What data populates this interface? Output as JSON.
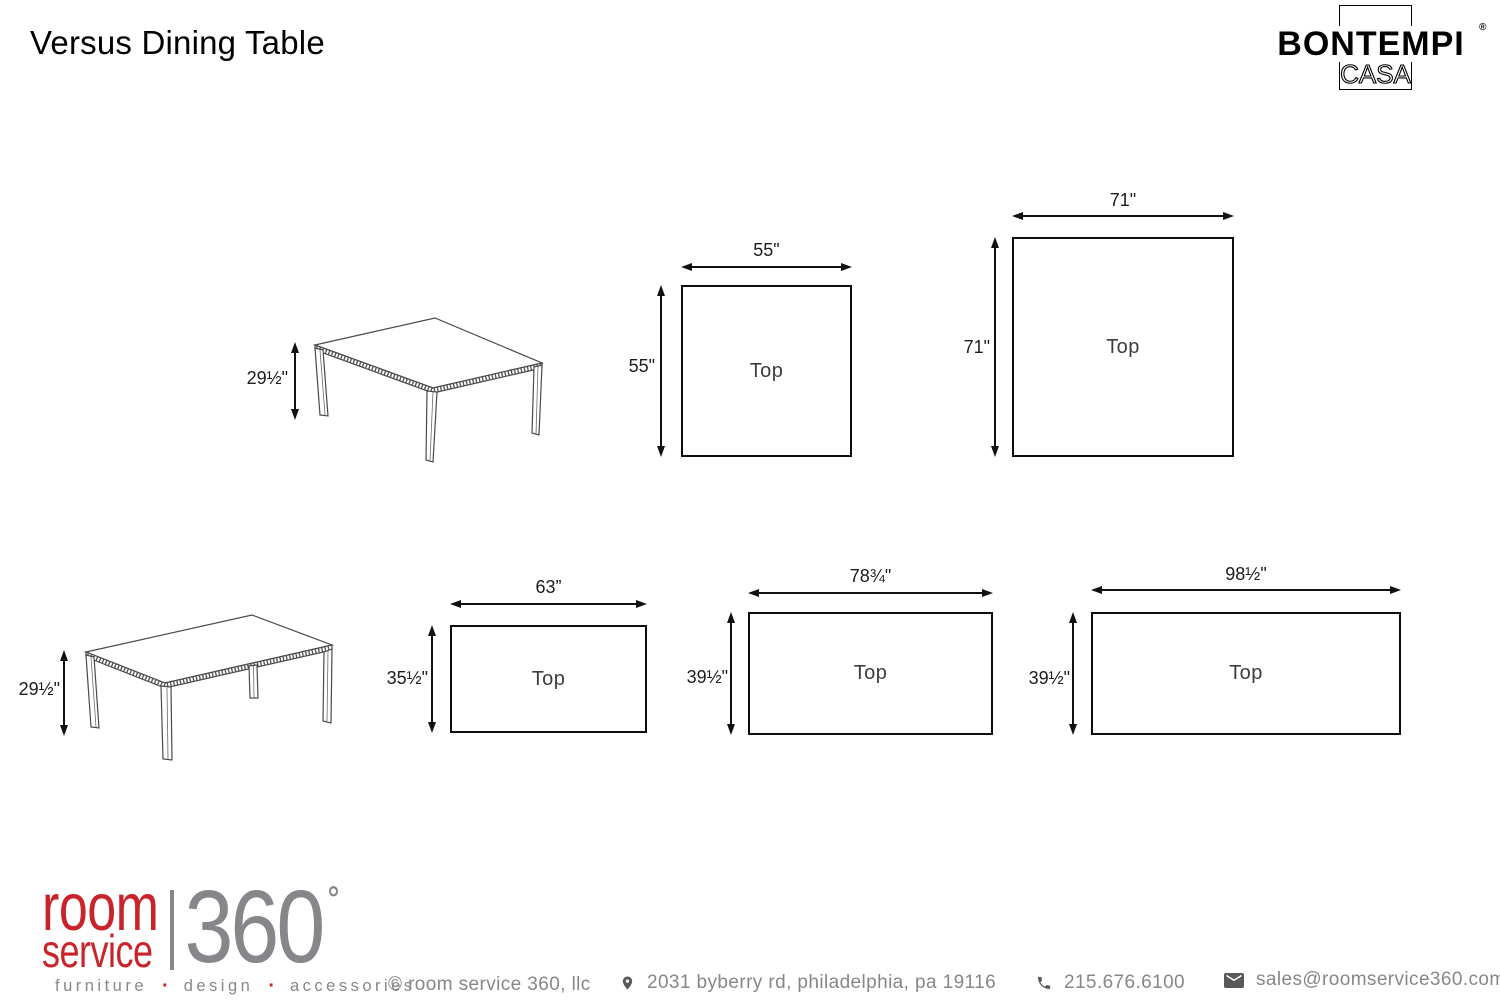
{
  "page": {
    "title": "Versus Dining Table"
  },
  "brand": {
    "name": "BONTEMPI",
    "registered_mark": "®",
    "subtitle": "CASA"
  },
  "side_views": [
    {
      "shape": "square-table",
      "height_label": "29½\""
    },
    {
      "shape": "rectangular-table",
      "height_label": "29½\""
    }
  ],
  "top_views": [
    {
      "width_label": "55\"",
      "height_label": "55\"",
      "area_label": "Top"
    },
    {
      "width_label": "71\"",
      "height_label": "71\"",
      "area_label": "Top"
    },
    {
      "width_label": "63”",
      "height_label": "35½\"",
      "area_label": "Top"
    },
    {
      "width_label": "78¾\"",
      "height_label": "39½\"",
      "area_label": "Top"
    },
    {
      "width_label": "98½\"",
      "height_label": "39½\"",
      "area_label": "Top"
    }
  ],
  "retailer_logo": {
    "word1": "room",
    "word2": "service",
    "number": "360",
    "tagline": {
      "word1": "furniture",
      "word2": "design",
      "word3": "accessories",
      "separator": "·"
    }
  },
  "footer": {
    "copyright": "© room service 360, llc",
    "address": "2031 byberry rd, philadelphia, pa 19116",
    "phone": "215.676.6100",
    "email": "sales@roomservice360.com"
  },
  "colors": {
    "accent_red": "#C9242B",
    "logo_gray": "#85878A",
    "line_black": "#111111"
  }
}
